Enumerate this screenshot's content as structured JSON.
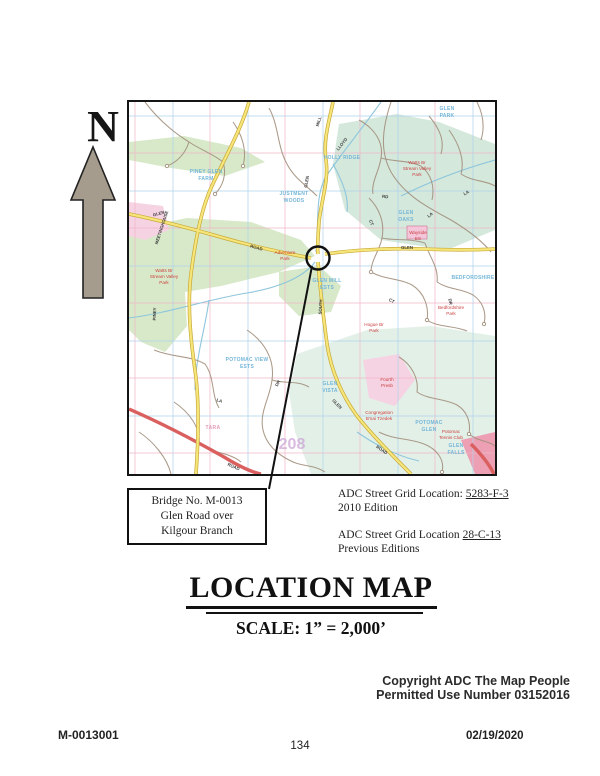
{
  "page": {
    "north_label": "N",
    "copyright": {
      "line1": "Copyright ADC The Map People",
      "line2": "Permitted Use Number 03152016"
    },
    "footer": {
      "doc_id": "M-0013001",
      "page_number": "134",
      "date": "02/19/2020"
    }
  },
  "callout": {
    "line1": "Bridge No. M-0013",
    "line2": "Glen Road over",
    "line3": "Kilgour Branch"
  },
  "grid_refs": {
    "current": {
      "prefix": "ADC Street Grid Location: ",
      "code": "5283-F-3",
      "edition": "2010 Edition"
    },
    "previous": {
      "prefix": "ADC Street Grid Location ",
      "code": "28-C-13",
      "edition": "Previous Editions"
    }
  },
  "title": {
    "heading": "LOCATION MAP",
    "scale": "SCALE: 1” = 2,000’"
  },
  "map": {
    "colors": {
      "yellow": "#f6e67a",
      "green": "#d7e9c9",
      "teal": "#d4e8dc",
      "paleteal": "#e3f0e8",
      "pink": "#f6d3e3",
      "gridblue": "#aed2ec",
      "gridpink": "#f0b6c6",
      "stream": "#8fc6dc",
      "redroad": "#da6060",
      "bluelabel": "#74b6d8",
      "redlabel": "#cc4040",
      "arrow": "#a59c8d"
    },
    "labels": [
      {
        "t": "MEETINGHOUSE",
        "x": 34,
        "y": 126,
        "r": -72,
        "k": "street"
      },
      {
        "t": "PINEY",
        "x": 27,
        "y": 212,
        "r": -88,
        "k": "street"
      },
      {
        "t": "GLEN",
        "x": 30,
        "y": 113,
        "r": -14,
        "k": "street"
      },
      {
        "t": "ROAD",
        "x": 127,
        "y": 147,
        "r": 16,
        "k": "street"
      },
      {
        "t": "GLEN",
        "x": 179,
        "y": 80,
        "r": -80,
        "k": "street"
      },
      {
        "t": "MILL",
        "x": 191,
        "y": 20,
        "r": -72,
        "k": "street"
      },
      {
        "t": "SOUTH",
        "x": 193,
        "y": 205,
        "r": -86,
        "k": "street"
      },
      {
        "t": "GLEN",
        "x": 207,
        "y": 303,
        "r": 46,
        "k": "street"
      },
      {
        "t": "ROAD",
        "x": 252,
        "y": 349,
        "r": 34,
        "k": "street"
      },
      {
        "t": "GLEN",
        "x": 278,
        "y": 147,
        "r": 0,
        "k": "street"
      },
      {
        "t": "LLOYD",
        "x": 214,
        "y": 43,
        "r": -52,
        "k": "street"
      },
      {
        "t": "ROAD",
        "x": 104,
        "y": 366,
        "r": 24,
        "k": "street"
      },
      {
        "t": "LA",
        "x": 302,
        "y": 114,
        "r": -38,
        "k": "street"
      },
      {
        "t": "CT",
        "x": 241,
        "y": 121,
        "r": 68,
        "k": "street"
      },
      {
        "t": "DR",
        "x": 320,
        "y": 200,
        "r": 78,
        "k": "street"
      },
      {
        "t": "CT",
        "x": 262,
        "y": 200,
        "r": 28,
        "k": "street"
      },
      {
        "t": "LA",
        "x": 90,
        "y": 300,
        "r": 18,
        "k": "street"
      },
      {
        "t": "DR",
        "x": 150,
        "y": 282,
        "r": -62,
        "k": "street"
      },
      {
        "t": "LA",
        "x": 338,
        "y": 92,
        "r": -30,
        "k": "street"
      },
      {
        "t": "RD",
        "x": 256,
        "y": 96,
        "r": 8,
        "k": "street"
      },
      {
        "t": "PINEY GLEN",
        "x": 77,
        "y": 71,
        "k": "area"
      },
      {
        "t": "FARM",
        "x": 77,
        "y": 78,
        "k": "area"
      },
      {
        "t": "JUSTMENT",
        "x": 165,
        "y": 93,
        "k": "area"
      },
      {
        "t": "WOODS",
        "x": 165,
        "y": 100,
        "k": "area"
      },
      {
        "t": "HOLLY RIDGE",
        "x": 213,
        "y": 57,
        "k": "area"
      },
      {
        "t": "GLEN",
        "x": 318,
        "y": 8,
        "k": "area"
      },
      {
        "t": "PARK",
        "x": 318,
        "y": 15,
        "k": "area"
      },
      {
        "t": "GLEN",
        "x": 277,
        "y": 112,
        "k": "area"
      },
      {
        "t": "OAKS",
        "x": 277,
        "y": 119,
        "k": "area"
      },
      {
        "t": "GLEN MILL",
        "x": 198,
        "y": 180,
        "k": "area"
      },
      {
        "t": "ESTS",
        "x": 198,
        "y": 187,
        "k": "area"
      },
      {
        "t": "GLEN",
        "x": 201,
        "y": 283,
        "k": "area"
      },
      {
        "t": "VISTA",
        "x": 201,
        "y": 290,
        "k": "area"
      },
      {
        "t": "POTOMAC VIEW",
        "x": 118,
        "y": 259,
        "k": "area"
      },
      {
        "t": "ESTS",
        "x": 118,
        "y": 266,
        "k": "area"
      },
      {
        "t": "POTOMAC",
        "x": 300,
        "y": 322,
        "k": "area"
      },
      {
        "t": "GLEN",
        "x": 300,
        "y": 329,
        "k": "area"
      },
      {
        "t": "GLEN",
        "x": 327,
        "y": 345,
        "k": "area"
      },
      {
        "t": "FALLS",
        "x": 327,
        "y": 352,
        "k": "area"
      },
      {
        "t": "BEDFORDSHIRE",
        "x": 344,
        "y": 177,
        "k": "area"
      },
      {
        "t": "TARA",
        "x": 84,
        "y": 327,
        "k": "pink"
      },
      {
        "t": "Watts Br",
        "x": 288,
        "y": 62,
        "k": "poi"
      },
      {
        "t": "Stream Valley",
        "x": 288,
        "y": 68,
        "k": "poi"
      },
      {
        "t": "Park",
        "x": 288,
        "y": 74,
        "k": "poi"
      },
      {
        "t": "Watts Br",
        "x": 35,
        "y": 170,
        "k": "poi"
      },
      {
        "t": "Stream Valley",
        "x": 35,
        "y": 176,
        "k": "poi"
      },
      {
        "t": "Park",
        "x": 35,
        "y": 182,
        "k": "poi"
      },
      {
        "t": "Adventure",
        "x": 156,
        "y": 152,
        "k": "poi"
      },
      {
        "t": "Park",
        "x": 156,
        "y": 158,
        "k": "poi"
      },
      {
        "t": "Wayside",
        "x": 289,
        "y": 132,
        "k": "poi"
      },
      {
        "t": "ES",
        "x": 289,
        "y": 138,
        "k": "poi"
      },
      {
        "t": "Bedfordshire",
        "x": 322,
        "y": 207,
        "k": "poi"
      },
      {
        "t": "Park",
        "x": 322,
        "y": 213,
        "k": "poi"
      },
      {
        "t": "Hogue Br",
        "x": 245,
        "y": 224,
        "k": "poi"
      },
      {
        "t": "Park",
        "x": 245,
        "y": 230,
        "k": "poi"
      },
      {
        "t": "Fourth",
        "x": 258,
        "y": 279,
        "k": "poi"
      },
      {
        "t": "Presb",
        "x": 258,
        "y": 285,
        "k": "poi"
      },
      {
        "t": "Congregation",
        "x": 250,
        "y": 312,
        "k": "poi"
      },
      {
        "t": "B'nai Tzedek",
        "x": 250,
        "y": 318,
        "k": "poi"
      },
      {
        "t": "Potomac",
        "x": 322,
        "y": 331,
        "k": "poi"
      },
      {
        "t": "Tennis Club",
        "x": 322,
        "y": 337,
        "k": "poi"
      },
      {
        "t": "208",
        "x": 163,
        "y": 347,
        "k": "num"
      }
    ]
  }
}
